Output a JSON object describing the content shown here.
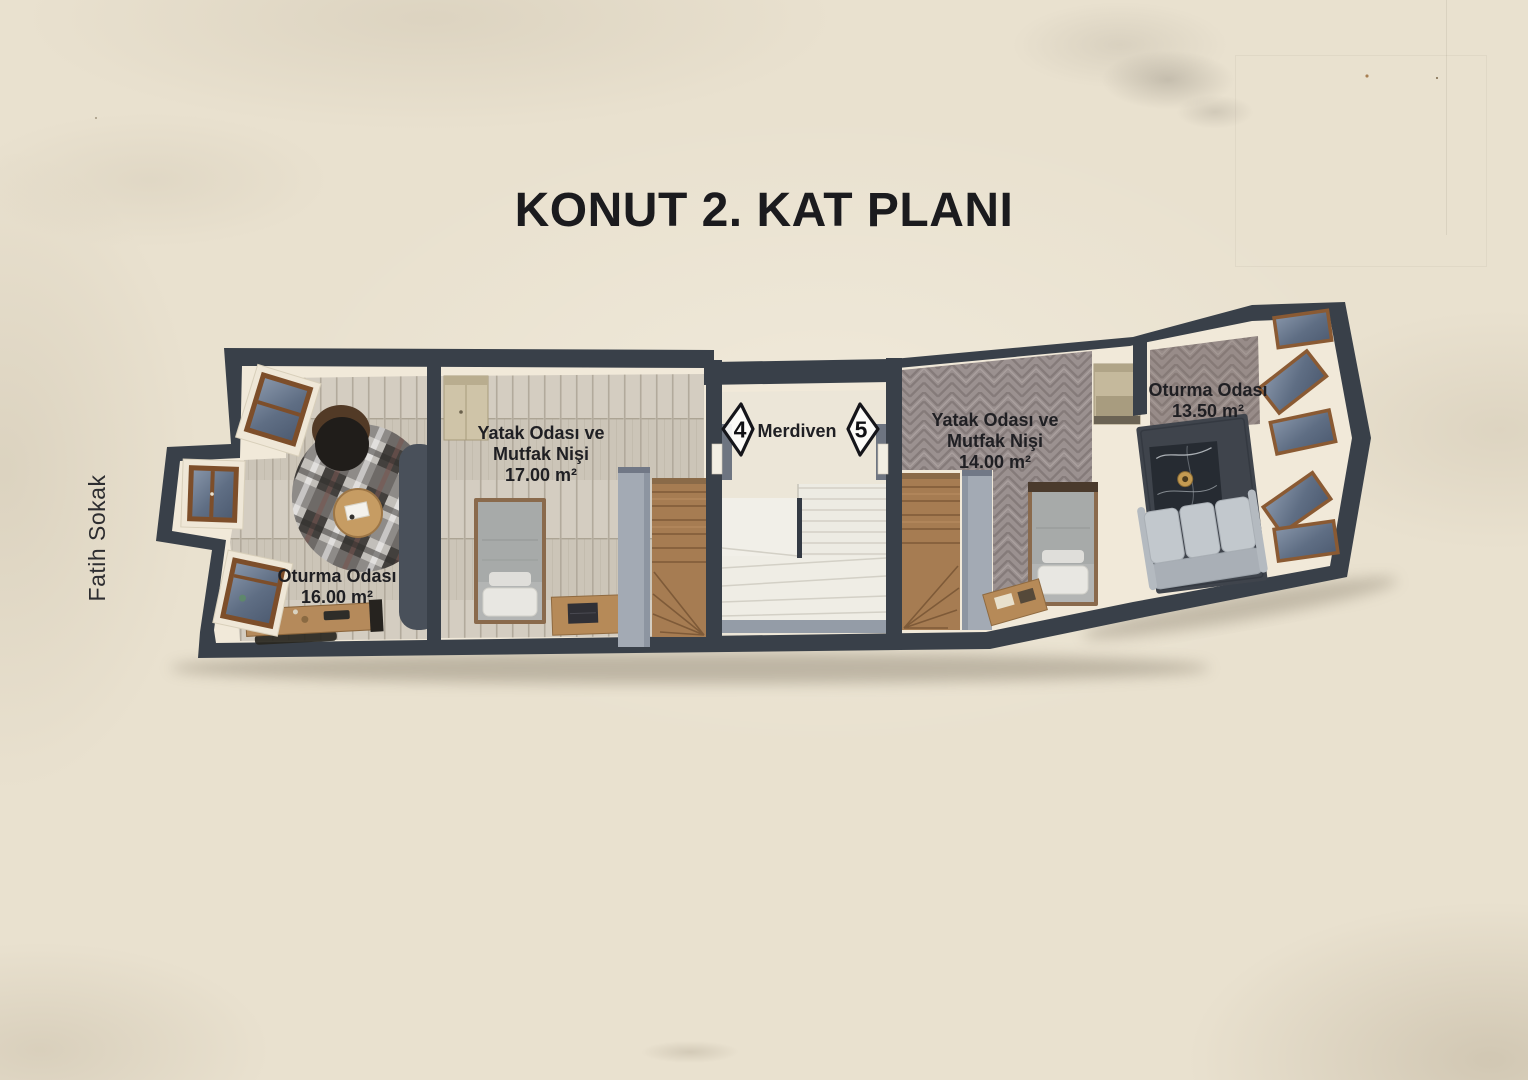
{
  "title": "KONUT 2. KAT PLANI",
  "street": {
    "label": "Fatih Sokak"
  },
  "plan": {
    "rooms": [
      {
        "id": "living-left",
        "name": "Oturma Odası",
        "area": "16.00 m²"
      },
      {
        "id": "bedroom-left",
        "name_line1": "Yatak Odası ve",
        "name_line2": "Mutfak Nişi",
        "area": "17.00 m²"
      },
      {
        "id": "staircase",
        "name": "Merdiven"
      },
      {
        "id": "bedroom-right",
        "name_line1": "Yatak Odası ve",
        "name_line2": "Mutfak Nişi",
        "area": "14.00 m²"
      },
      {
        "id": "living-right",
        "name": "Oturma Odası",
        "area": "13.50 m²"
      }
    ],
    "unit_markers": [
      {
        "number": "4"
      },
      {
        "number": "5"
      }
    ]
  },
  "colors": {
    "background": "#e9e1cf",
    "wall": "#394049",
    "wall_face": "#f1e9d9",
    "wood_stairs": "#a67c52",
    "white_stairs": "#efede5"
  }
}
